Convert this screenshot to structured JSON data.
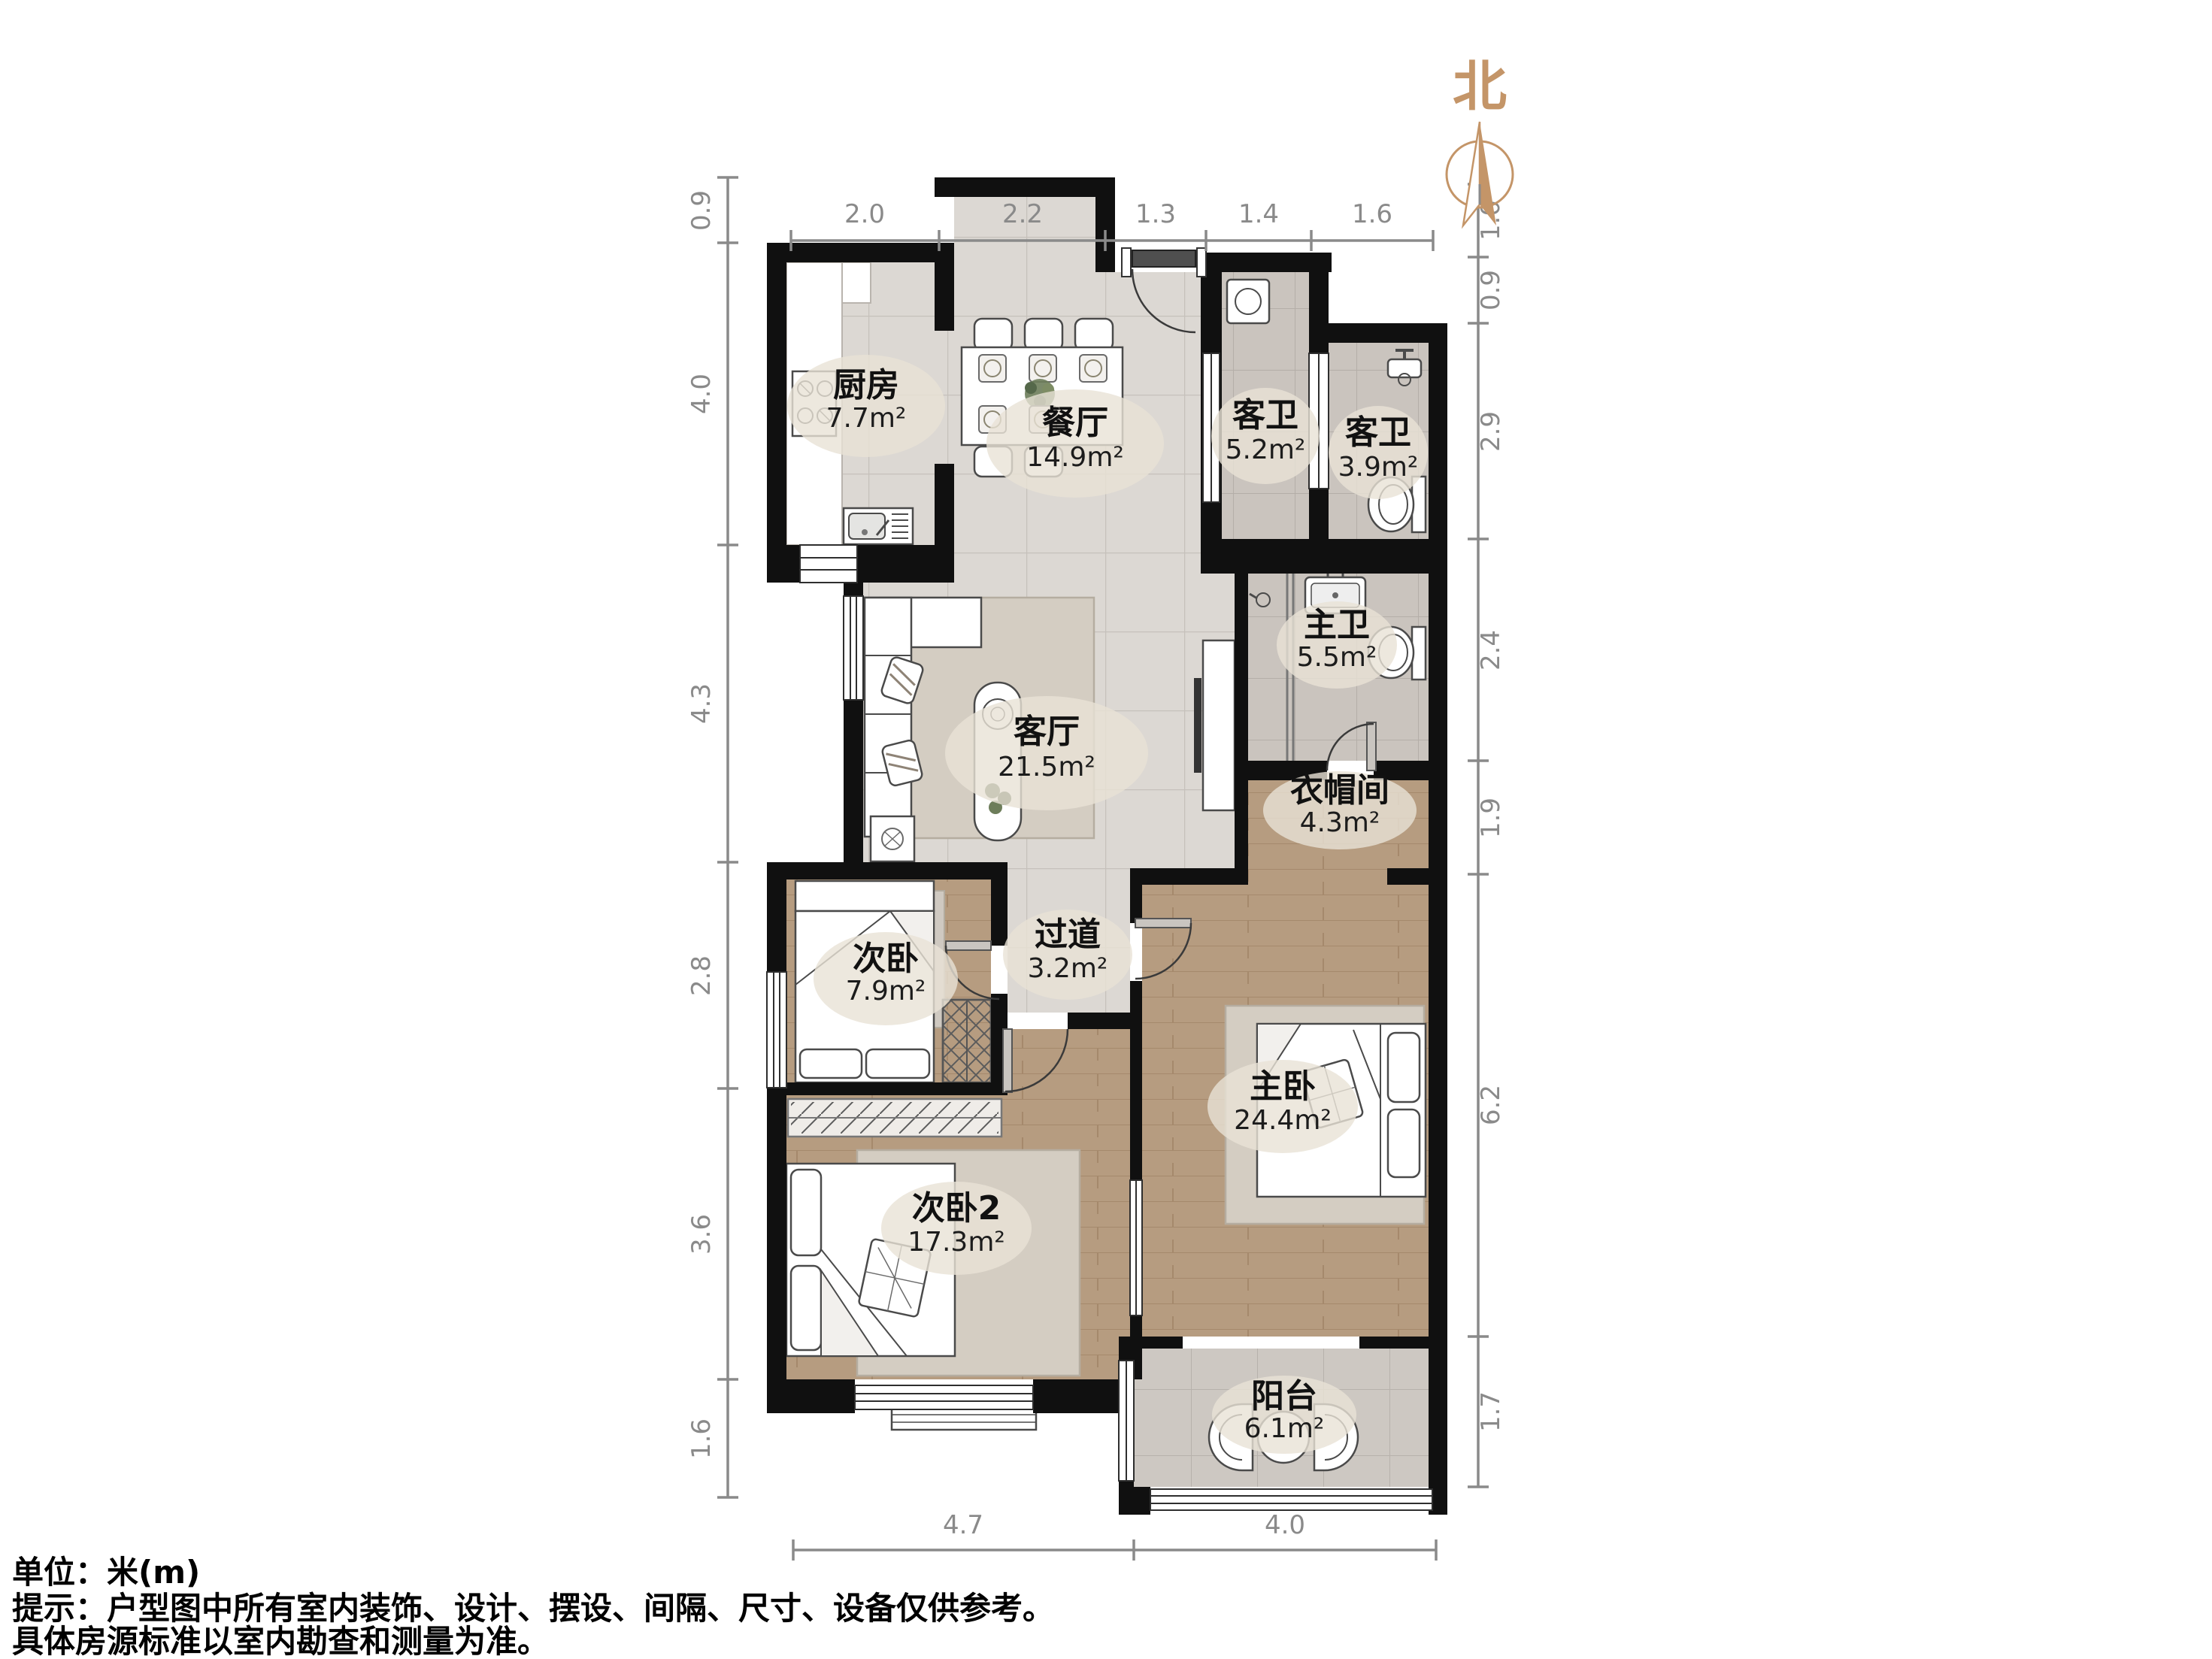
{
  "title": "户型图",
  "north": {
    "label": "北"
  },
  "rooms": {
    "kitchen": {
      "name": "厨房",
      "area": "7.7m²"
    },
    "dining": {
      "name": "餐厅",
      "area": "14.9m²"
    },
    "guest_bath": {
      "name": "客卫",
      "area": "5.2m²"
    },
    "guest_bath2": {
      "name": "客卫",
      "area": "3.9m²"
    },
    "master_bath": {
      "name": "主卫",
      "area": "5.5m²"
    },
    "living": {
      "name": "客厅",
      "area": "21.5m²"
    },
    "cloakroom": {
      "name": "衣帽间",
      "area": "4.3m²"
    },
    "hallway": {
      "name": "过道",
      "area": "3.2m²"
    },
    "bedroom": {
      "name": "次卧",
      "area": "7.9m²"
    },
    "master_bedroom": {
      "name": "主卧",
      "area": "24.4m²"
    },
    "bedroom2": {
      "name": "次卧2",
      "area": "17.3m²"
    },
    "balcony": {
      "name": "阳台",
      "area": "6.1m²"
    }
  },
  "dims": {
    "top": [
      "2.0",
      "2.2",
      "1.3",
      "1.4",
      "1.6"
    ],
    "left": [
      "0.9",
      "4.0",
      "4.3",
      "2.8",
      "3.6",
      "1.6"
    ],
    "right": [
      "1.0",
      "0.9",
      "2.9",
      "2.4",
      "1.9",
      "6.2",
      "1.7"
    ],
    "bottom": [
      "4.7",
      "4.0"
    ]
  },
  "notes": {
    "unit": "单位：米(m)",
    "tip1": "提示：户型图中所有室内装饰、设计、摆设、间隔、尺寸、设备仅供参考。",
    "tip2": "具体房源标准以室内勘查和测量为准。"
  },
  "colors": {
    "wall": "#101010",
    "wood_floor": "#b69c80",
    "tile_floor": "#dcd8d3",
    "bath_tile": "#cac4be",
    "north_accent": "#c49568",
    "dimension": "#8a8a8a"
  }
}
